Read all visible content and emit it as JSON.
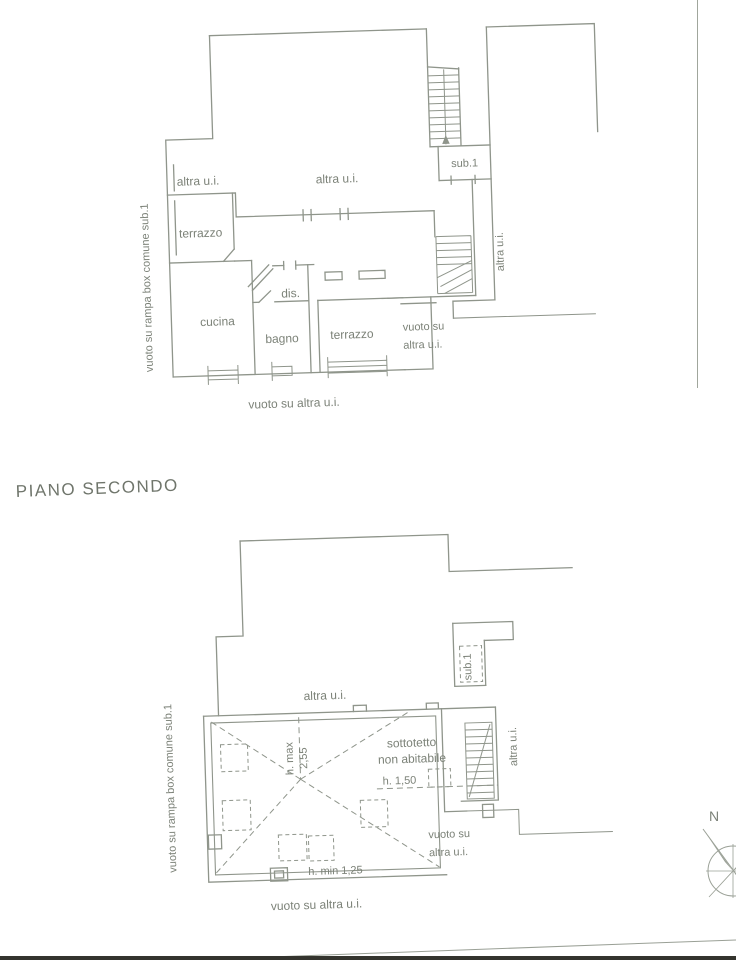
{
  "page": {
    "background": "#ffffff",
    "line_ink": "#8f958b",
    "text_ink": "#7c8278",
    "edge_bar_color": "#34342e"
  },
  "floor_title": "PIANO SECONDO",
  "upper_plan": {
    "side_caption": "vuoto su rampa box comune sub.1",
    "labels": {
      "altra_ui_left": "altra u.i.",
      "altra_ui_center": "altra u.i.",
      "sub1": "sub.1",
      "terrazzo_upper": "terrazzo",
      "cucina": "cucina",
      "dis": "dis.",
      "bagno": "bagno",
      "terrazzo_lower": "terrazzo",
      "vuoto_line1": "vuoto su",
      "vuoto_line2": "altra u.i.",
      "altra_ui_right": "altra u.i.",
      "bottom_caption": "vuoto su altra u.i."
    }
  },
  "lower_plan": {
    "side_caption": "vuoto su rampa box comune sub.1",
    "labels": {
      "altra_ui_top": "altra u.i.",
      "sub1": "sub.1",
      "sottotetto_line1": "sottotetto",
      "sottotetto_line2": "non abitabile",
      "h_max_line1": "h. max",
      "h_max_line2": "2,55",
      "h_mid": "h. 1,50",
      "h_min": "h. min 1,25",
      "altra_ui_right": "altra u.i.",
      "vuoto_line1": "vuoto su",
      "vuoto_line2": "altra u.i.",
      "bottom_caption": "vuoto su altra u.i."
    }
  },
  "compass": {
    "north": "N"
  }
}
